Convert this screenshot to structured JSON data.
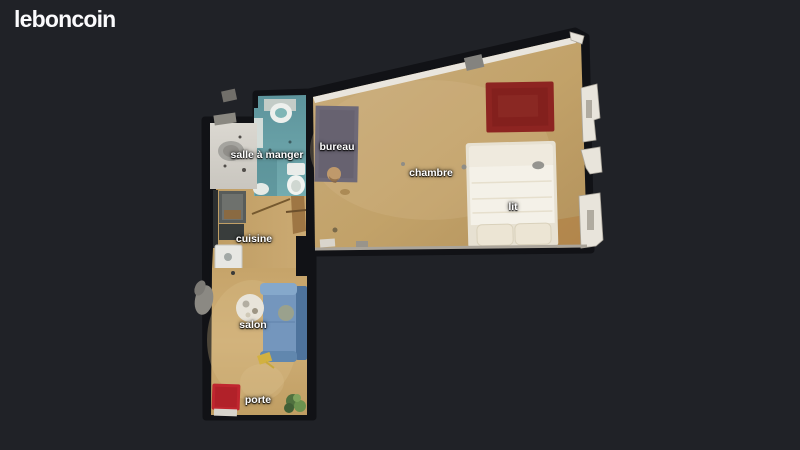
{
  "header": {
    "logo_text": "leboncoin"
  },
  "floorplan": {
    "view_type": "3d-dollhouse-floorplan",
    "background_color": "#202227",
    "labels": [
      {
        "id": "salle-a-manger",
        "text": "salle à manger"
      },
      {
        "id": "bureau",
        "text": "bureau"
      },
      {
        "id": "chambre",
        "text": "chambre"
      },
      {
        "id": "lit",
        "text": "lit"
      },
      {
        "id": "cuisine",
        "text": "cuisine"
      },
      {
        "id": "salon",
        "text": "salon"
      },
      {
        "id": "porte",
        "text": "porte"
      }
    ],
    "colors": {
      "wood_floor": "#c2a269",
      "bedroom_rug_red": "#8d2421",
      "doormat_red": "#c0262f",
      "bathroom_teal": "#6ba2a8",
      "sofa_blue": "#7496bd",
      "desk_rug_gray": "#6e6977",
      "bed_white": "#f4f1e8",
      "wall_dark": "#111216",
      "wall_light": "#e9e5dd",
      "label_text": "#ffffff"
    }
  }
}
